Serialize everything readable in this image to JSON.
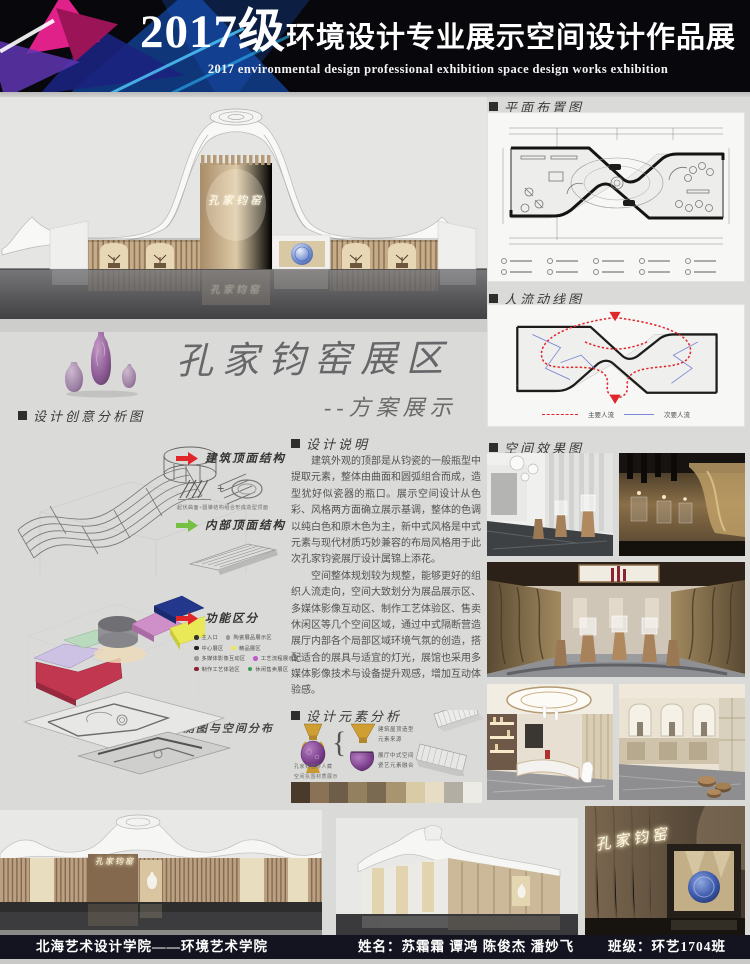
{
  "header": {
    "title_year": "2017级",
    "title_main": "环境设计专业展示空间设计作品展",
    "subtitle_en": "2017 environmental design professional exhibition space design works exhibition"
  },
  "hero": {
    "sign": "孔家钧窑"
  },
  "project": {
    "title": "孔家钧窑展区",
    "subtitle": "--方案展示"
  },
  "creative": {
    "heading": "设计创意分析图",
    "label_roof": "建筑顶面结构",
    "roof_caption": "起伏曲面+圆锥结构组合形成造型顶面",
    "plus": "+",
    "label_inner": "内部顶面结构",
    "label_zone": "功能区分",
    "zone_legend": [
      {
        "color": "#333331",
        "label": "主入口"
      },
      {
        "color": "#9a9a98",
        "label": "陶瓷展品展示区"
      },
      {
        "color": "#222220",
        "label": "中心展区"
      },
      {
        "color": "#e9e957",
        "label": "精品展区"
      },
      {
        "color": "#9a9a98",
        "label": "多媒体影像互动区"
      },
      {
        "color": "#c05ccb",
        "label": "工艺流程展示区"
      },
      {
        "color": "#8b2130",
        "label": "制作工艺体验区"
      },
      {
        "color": "#3a9e4e",
        "label": "休闲售卖展区"
      }
    ],
    "axon_title": "轴测图与空间分布"
  },
  "description": {
    "heading": "设计说明",
    "para1": "建筑外观的顶部是从钧瓷的一般瓶型中提取元素，整体由曲面和圆弧组合而成，造型犹好似瓷器的瓶口。展示空间设计从色彩、风格两方面确立展示基调，整体的色调以纯白色和原木色为主，新中式风格是中式元素与现代材质巧妙兼容的布局风格用于此次孔家钧瓷展厅设计属锦上添花。",
    "para2": "空间整体规划较为规整，能够更好的组织人流走向，空间大致划分为展品展示区、多媒体影像互动区、制作工艺体验区、售卖休闲区等几个空间区域，通过中式隔断营造展厅内部各个局部区域环境气氛的创造，搭配适合的展具与适宜的灯光，展馆也采用多媒体影像技术与设备提升观感，增加互动体验感。"
  },
  "elements": {
    "heading": "设计元素分析",
    "brace": "{",
    "label_roof_line1": "建筑屋顶造型",
    "label_roof_line2": "元素来源",
    "label_space_line1": "展厅中式空间",
    "label_space_line2": "瓷艺元素融合",
    "caption_vase": "孔家钧窑传人藏",
    "caption_material": "空间氛围材质展示",
    "swatches": [
      "#4a3a2a",
      "#8a7257",
      "#6e5e49",
      "#93805f",
      "#7a6a52",
      "#a8946f",
      "#d9cba6",
      "#e7ddc4",
      "#b3aea4",
      "#edebe5"
    ]
  },
  "floor_plan": {
    "heading": "平面布置图"
  },
  "circulation": {
    "heading": "人流动线图",
    "legend_main": "主要人流",
    "legend_secondary": "次要人流"
  },
  "renderings": {
    "heading": "空间效果图"
  },
  "bottom": {
    "sign_left": "孔家钧窑",
    "sign_right": "孔家钧窑"
  },
  "footer": {
    "school": "北海艺术设计学院——环境艺术学院",
    "names": "姓名：苏霜霜  谭鸿  陈俊杰  潘妙飞",
    "class_name": "班级：环艺1704班"
  },
  "colors": {
    "accent_red": "#e0262a",
    "accent_green": "#76c043",
    "circulation_main": "#e0262a",
    "circulation_secondary": "#7b88d8"
  }
}
